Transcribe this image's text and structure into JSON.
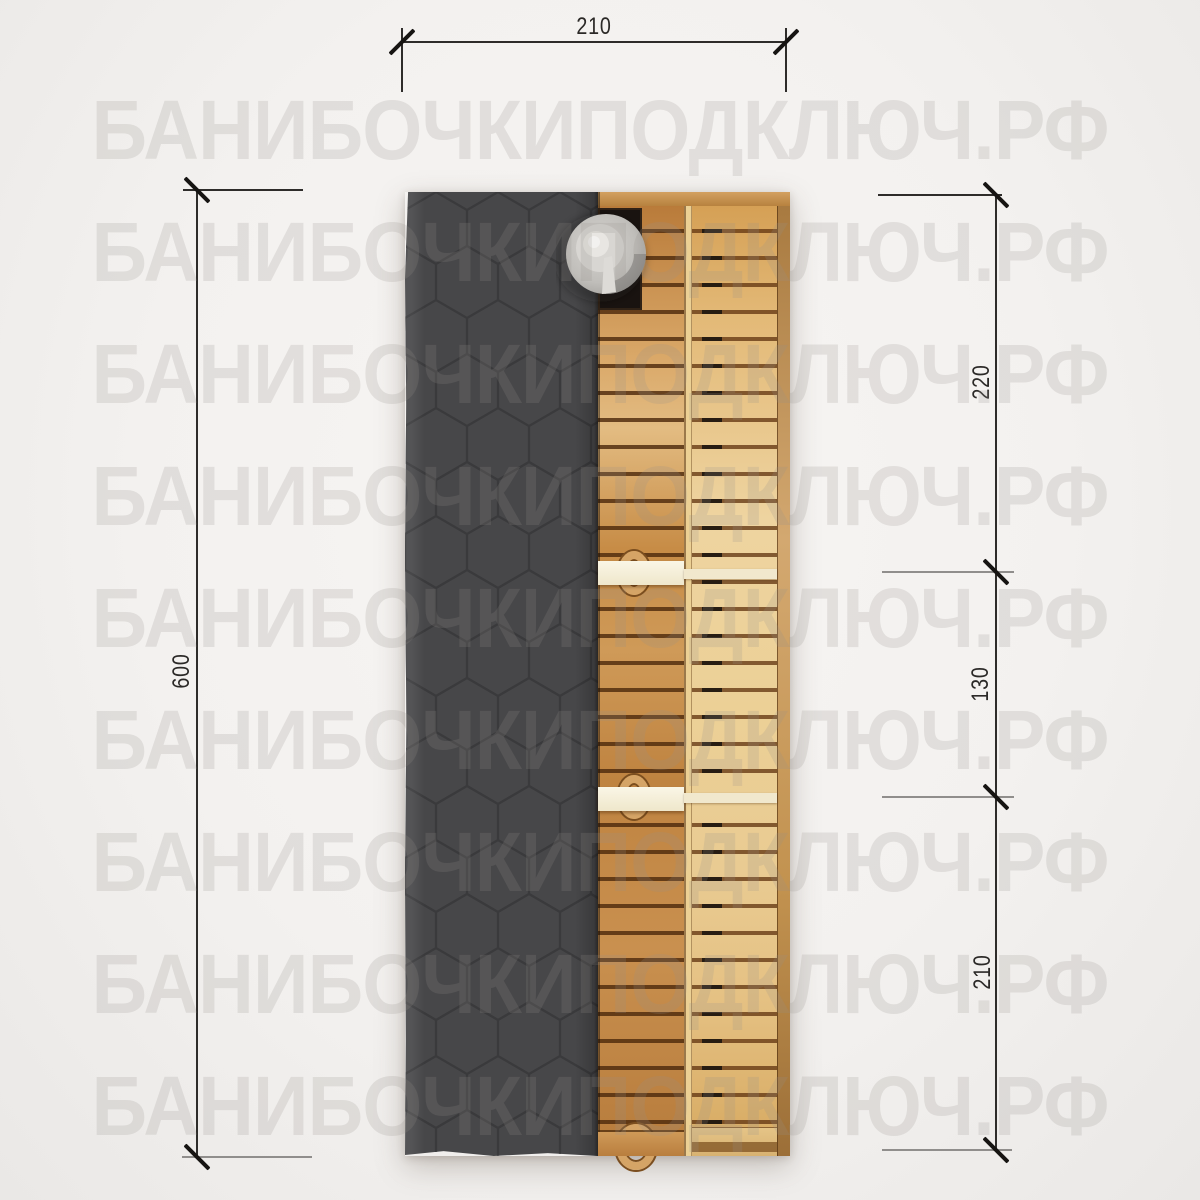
{
  "watermark": {
    "text": "БАНИБОЧКИПОДКЛЮЧ.РФ",
    "rows": 9
  },
  "dimensions": {
    "top": {
      "value": "210",
      "orientation": "horizontal"
    },
    "left": {
      "value": "600",
      "orientation": "vertical"
    },
    "right_segments": [
      {
        "value": "220"
      },
      {
        "value": "130"
      },
      {
        "value": "210"
      }
    ]
  },
  "drawing": {
    "colors": {
      "background": "#f2f0ee",
      "roof_shingles": "#474749",
      "roof_pattern_line": "#3a3a3c",
      "wood_dark": "#b97b3a",
      "wood_light": "#ecd096",
      "slat_gap": "#6e3c14",
      "partition_white": "#f6f1dd",
      "stove_black": "#191310",
      "chimney_cap_gray": "#c6c4c0",
      "dimension_line": "#2e2c2a"
    }
  }
}
